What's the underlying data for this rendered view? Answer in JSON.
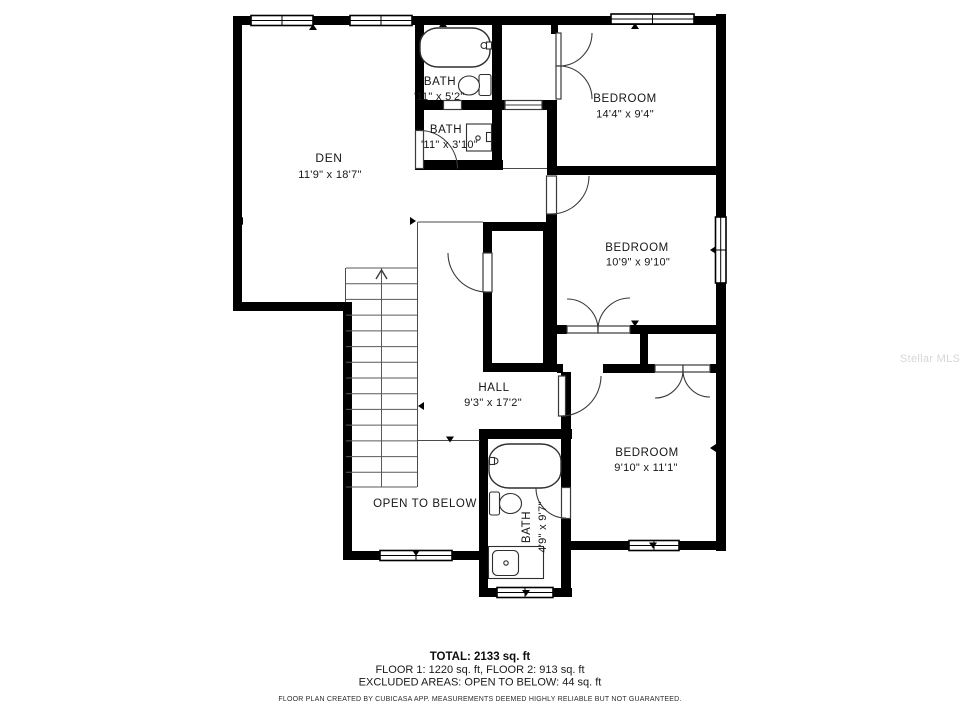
{
  "plan": {
    "rooms": {
      "den": {
        "label": "DEN",
        "dims": "11'9\" x 18'7\""
      },
      "bath_top": {
        "label": "BATH",
        "dims": "'11\" x 5'2\""
      },
      "bath_mid": {
        "label": "BATH",
        "dims": "'11\" x 3'10\""
      },
      "bedroom_top": {
        "label": "BEDROOM",
        "dims": "14'4\" x 9'4\""
      },
      "bedroom_mid": {
        "label": "BEDROOM",
        "dims": "10'9\" x 9'10\""
      },
      "hall": {
        "label": "HALL",
        "dims": "9'3\" x 17'2\""
      },
      "bedroom_bot": {
        "label": "BEDROOM",
        "dims": "9'10\" x 11'1\""
      },
      "bath_bot": {
        "label": "BATH",
        "dims": "4'9\" x 9'7\""
      },
      "open_below": {
        "label": "OPEN TO BELOW"
      }
    }
  },
  "summary": {
    "total": "TOTAL: 2133 sq. ft",
    "floors": "FLOOR 1: 1220 sq. ft, FLOOR 2: 913 sq. ft",
    "excluded": "EXCLUDED AREAS: OPEN TO BELOW: 44 sq. ft",
    "disclaimer": "FLOOR PLAN CREATED BY CUBICASA APP. MEASUREMENTS DEEMED HIGHLY RELIABLE BUT NOT GUARANTEED."
  },
  "watermark": "Stellar MLS",
  "colors": {
    "wall": "#000000",
    "background": "#ffffff",
    "text": "#161616",
    "watermark": "#d7d7d7"
  }
}
